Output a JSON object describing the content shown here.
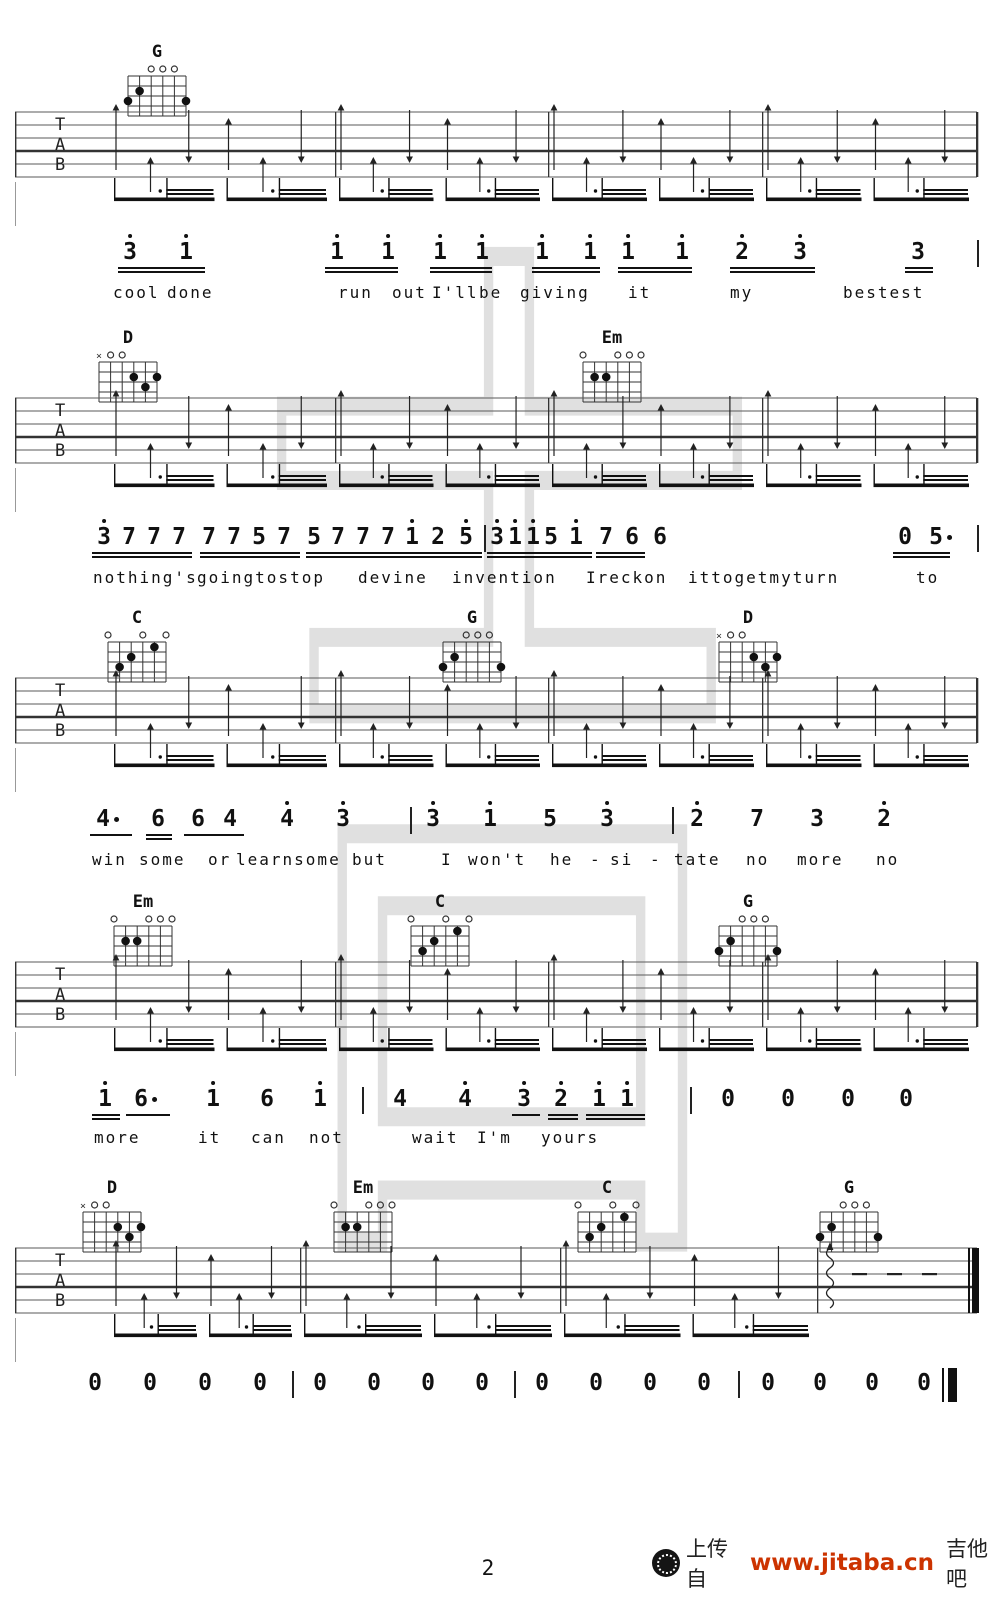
{
  "page": {
    "bg": "#ffffff",
    "ink": "#161616",
    "watermark_char": "吉",
    "watermark_color": "#dbdbdb"
  },
  "footer": {
    "page_number": "2",
    "upload_text": "上传自",
    "site_url": "www.jitaba.cn",
    "site_suffix": "吉他吧",
    "url_color": "#cc3300"
  },
  "tab_letters": [
    "T",
    "A",
    "B"
  ],
  "chord_shapes": {
    "G": {
      "markers": [
        [
          4,
          "o"
        ],
        [
          3,
          "o"
        ],
        [
          2,
          "o"
        ]
      ],
      "dots": [
        [
          5,
          2
        ],
        [
          6,
          3
        ],
        [
          1,
          3
        ]
      ]
    },
    "D": {
      "markers": [
        [
          6,
          "x"
        ],
        [
          5,
          "o"
        ],
        [
          4,
          "o"
        ]
      ],
      "dots": [
        [
          3,
          2
        ],
        [
          1,
          2
        ],
        [
          2,
          3
        ]
      ]
    },
    "Em": {
      "markers": [
        [
          6,
          "o"
        ],
        [
          3,
          "o"
        ],
        [
          2,
          "o"
        ],
        [
          1,
          "o"
        ]
      ],
      "dots": [
        [
          5,
          2
        ],
        [
          4,
          2
        ]
      ]
    },
    "C": {
      "markers": [
        [
          6,
          "o"
        ],
        [
          3,
          "o"
        ],
        [
          1,
          "o"
        ]
      ],
      "dots": [
        [
          2,
          1
        ],
        [
          4,
          2
        ],
        [
          5,
          3
        ]
      ]
    }
  },
  "systems": [
    {
      "staff_top": 112,
      "chord_label_y": 42,
      "chords": [
        {
          "name": "G",
          "x": 157
        }
      ],
      "measures": [
        110,
        335,
        548,
        762,
        977
      ],
      "final": false
    },
    {
      "staff_top": 398,
      "chord_label_y": 328,
      "chords": [
        {
          "name": "D",
          "x": 128
        },
        {
          "name": "Em",
          "x": 612
        }
      ],
      "measures": [
        110,
        335,
        548,
        762,
        977
      ],
      "final": false
    },
    {
      "staff_top": 678,
      "chord_label_y": 608,
      "chords": [
        {
          "name": "C",
          "x": 137
        },
        {
          "name": "G",
          "x": 472
        },
        {
          "name": "D",
          "x": 748
        }
      ],
      "measures": [
        110,
        335,
        548,
        762,
        977
      ],
      "final": false
    },
    {
      "staff_top": 962,
      "chord_label_y": 892,
      "chords": [
        {
          "name": "Em",
          "x": 143
        },
        {
          "name": "C",
          "x": 440
        },
        {
          "name": "G",
          "x": 748
        }
      ],
      "measures": [
        110,
        335,
        548,
        762,
        977
      ],
      "final": false
    },
    {
      "staff_top": 1248,
      "chord_label_y": 1178,
      "chords": [
        {
          "name": "D",
          "x": 112
        },
        {
          "name": "Em",
          "x": 363
        },
        {
          "name": "C",
          "x": 607
        },
        {
          "name": "G",
          "x": 849
        }
      ],
      "measures": [
        110,
        300,
        560,
        817
      ],
      "final": true,
      "tail": {
        "wavy_x": 830,
        "dash_xs": [
          852,
          887,
          922
        ],
        "thin_x": 968,
        "thick_x": 972
      }
    }
  ],
  "melody_lines": [
    {
      "num_y": 253,
      "lyr_y": 283,
      "notes": [
        {
          "d": "3",
          "x": 130,
          "hi": 1
        },
        {
          "d": "1",
          "x": 186,
          "hi": 1
        },
        {
          "d": "1",
          "x": 337,
          "hi": 1
        },
        {
          "d": "1",
          "x": 388,
          "hi": 1
        },
        {
          "d": "1",
          "x": 440,
          "hi": 1
        },
        {
          "d": "1",
          "x": 482,
          "hi": 1
        },
        {
          "d": "1",
          "x": 542,
          "hi": 1
        },
        {
          "d": "1",
          "x": 590,
          "hi": 1
        },
        {
          "d": "1",
          "x": 628,
          "hi": 1
        },
        {
          "d": "1",
          "x": 682,
          "hi": 1
        },
        {
          "d": "2",
          "x": 742,
          "hi": 1
        },
        {
          "d": "3",
          "x": 800,
          "hi": 1
        },
        {
          "d": "3",
          "x": 918,
          "hi": 0
        }
      ],
      "bars": [
        977
      ],
      "ug": [
        [
          118,
          205,
          2
        ],
        [
          325,
          398,
          2
        ],
        [
          430,
          492,
          2
        ],
        [
          532,
          600,
          2
        ],
        [
          618,
          692,
          2
        ],
        [
          730,
          815,
          2
        ],
        [
          905,
          933,
          2
        ]
      ],
      "lyrics": [
        {
          "t": "cool",
          "x": 113
        },
        {
          "t": "done",
          "x": 167
        },
        {
          "t": "run",
          "x": 338
        },
        {
          "t": "out",
          "x": 392
        },
        {
          "t": "I'll",
          "x": 432
        },
        {
          "t": "be",
          "x": 479
        },
        {
          "t": "giving",
          "x": 520
        },
        {
          "t": "it",
          "x": 628
        },
        {
          "t": "my",
          "x": 730
        },
        {
          "t": "bestest",
          "x": 843
        }
      ]
    },
    {
      "num_y": 538,
      "lyr_y": 568,
      "notes": [
        {
          "d": "3",
          "x": 104,
          "hi": 1
        },
        {
          "d": "7",
          "x": 129
        },
        {
          "d": "7",
          "x": 154
        },
        {
          "d": "7",
          "x": 179
        },
        {
          "d": "7",
          "x": 209
        },
        {
          "d": "7",
          "x": 234
        },
        {
          "d": "5",
          "x": 259
        },
        {
          "d": "7",
          "x": 284
        },
        {
          "d": "5",
          "x": 314
        },
        {
          "d": "7",
          "x": 338
        },
        {
          "d": "7",
          "x": 363
        },
        {
          "d": "7",
          "x": 388
        },
        {
          "d": "1",
          "x": 412,
          "hi": 1
        },
        {
          "d": "2",
          "x": 438
        },
        {
          "d": "5",
          "x": 466,
          "hi": 1
        },
        {
          "d": "3",
          "x": 497,
          "hi": 1
        },
        {
          "d": "1",
          "x": 515,
          "hi": 1
        },
        {
          "d": "1",
          "x": 533,
          "hi": 1
        },
        {
          "d": "5",
          "x": 551
        },
        {
          "d": "1",
          "x": 576,
          "hi": 1
        },
        {
          "d": "7",
          "x": 606
        },
        {
          "d": "6",
          "x": 632
        },
        {
          "d": "6",
          "x": 660
        },
        {
          "d": "0",
          "x": 905
        },
        {
          "d": "5",
          "x": 936,
          "aug": 1
        }
      ],
      "bars": [
        484,
        977
      ],
      "ug": [
        [
          92,
          192,
          2
        ],
        [
          200,
          300,
          2
        ],
        [
          306,
          482,
          2
        ],
        [
          487,
          592,
          2
        ],
        [
          596,
          645,
          2
        ],
        [
          893,
          950,
          2
        ]
      ],
      "lyrics": [
        {
          "t": "nothing's",
          "x": 93
        },
        {
          "t": "goingtostop",
          "x": 197
        },
        {
          "t": "devine",
          "x": 358
        },
        {
          "t": "invention",
          "x": 452
        },
        {
          "t": "Ireckon",
          "x": 586
        },
        {
          "t": "ittogetmyturn",
          "x": 688
        },
        {
          "t": "to",
          "x": 916
        }
      ]
    },
    {
      "num_y": 820,
      "lyr_y": 850,
      "notes": [
        {
          "d": "4",
          "x": 103,
          "aug": 1
        },
        {
          "d": "6",
          "x": 158
        },
        {
          "d": "6",
          "x": 198
        },
        {
          "d": "4",
          "x": 230
        },
        {
          "d": "4",
          "x": 287,
          "hi": 1
        },
        {
          "d": "3",
          "x": 343,
          "hi": 1
        },
        {
          "d": "3",
          "x": 433,
          "hi": 1
        },
        {
          "d": "1",
          "x": 490,
          "hi": 1
        },
        {
          "d": "5",
          "x": 550
        },
        {
          "d": "3",
          "x": 607,
          "hi": 1
        },
        {
          "d": "2",
          "x": 697,
          "hi": 1
        },
        {
          "d": "7",
          "x": 757
        },
        {
          "d": "3",
          "x": 817
        },
        {
          "d": "2",
          "x": 884,
          "hi": 1
        }
      ],
      "bars": [
        410,
        672
      ],
      "ug": [
        [
          90,
          132,
          1
        ],
        [
          146,
          172,
          2
        ],
        [
          184,
          244,
          1
        ]
      ],
      "lyrics": [
        {
          "t": "win",
          "x": 92
        },
        {
          "t": "some",
          "x": 139
        },
        {
          "t": "or",
          "x": 208
        },
        {
          "t": "learnsome",
          "x": 236
        },
        {
          "t": "but",
          "x": 352
        },
        {
          "t": "I",
          "x": 441
        },
        {
          "t": "won't",
          "x": 468
        },
        {
          "t": "he",
          "x": 550
        },
        {
          "t": "-",
          "x": 590
        },
        {
          "t": "si",
          "x": 610
        },
        {
          "t": "-",
          "x": 650
        },
        {
          "t": "tate",
          "x": 674
        },
        {
          "t": "no",
          "x": 746
        },
        {
          "t": "more",
          "x": 797
        },
        {
          "t": "no",
          "x": 876
        }
      ]
    },
    {
      "num_y": 1100,
      "lyr_y": 1128,
      "notes": [
        {
          "d": "1",
          "x": 105,
          "hi": 1
        },
        {
          "d": "6",
          "x": 141,
          "aug": 1
        },
        {
          "d": "1",
          "x": 213,
          "hi": 1
        },
        {
          "d": "6",
          "x": 267
        },
        {
          "d": "1",
          "x": 320,
          "hi": 1
        },
        {
          "d": "4",
          "x": 400
        },
        {
          "d": "4",
          "x": 465,
          "hi": 1
        },
        {
          "d": "3",
          "x": 524,
          "hi": 1
        },
        {
          "d": "2",
          "x": 561,
          "hi": 1
        },
        {
          "d": "1",
          "x": 599,
          "hi": 1
        },
        {
          "d": "1",
          "x": 627,
          "hi": 1
        },
        {
          "d": "0",
          "x": 728
        },
        {
          "d": "0",
          "x": 788
        },
        {
          "d": "0",
          "x": 848
        },
        {
          "d": "0",
          "x": 906
        }
      ],
      "bars": [
        362,
        690
      ],
      "ug": [
        [
          92,
          120,
          2
        ],
        [
          126,
          170,
          1
        ],
        [
          512,
          540,
          1
        ],
        [
          548,
          578,
          2
        ],
        [
          586,
          645,
          2
        ]
      ],
      "lyrics": [
        {
          "t": "more",
          "x": 94
        },
        {
          "t": "it",
          "x": 198
        },
        {
          "t": "can",
          "x": 251
        },
        {
          "t": "not",
          "x": 309
        },
        {
          "t": "wait",
          "x": 412
        },
        {
          "t": "I'm",
          "x": 477
        },
        {
          "t": "yours",
          "x": 541
        }
      ]
    }
  ],
  "final_line": {
    "num_y": 1384,
    "zeros": [
      95,
      150,
      205,
      260,
      320,
      374,
      428,
      482,
      542,
      596,
      650,
      704,
      768,
      820,
      872,
      924
    ],
    "bars": [
      292,
      514,
      738
    ],
    "end_thin": 942,
    "end_thick": 948
  }
}
